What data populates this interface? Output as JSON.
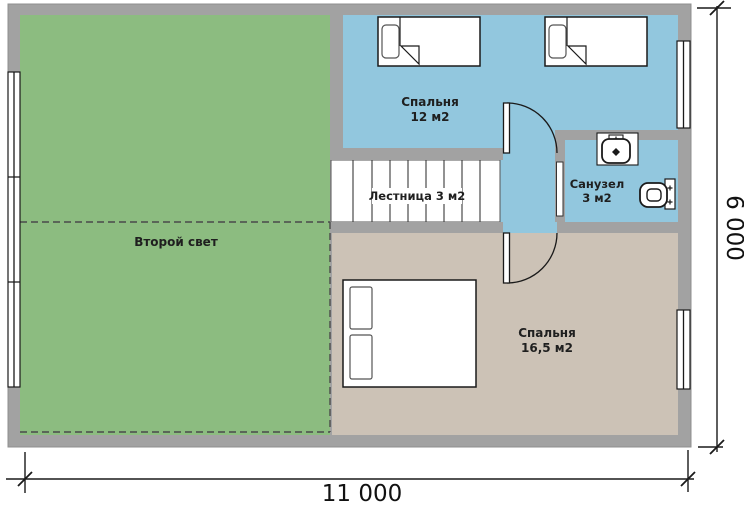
{
  "rooms": [
    {
      "id": "second-light",
      "label": "Второй свет"
    },
    {
      "id": "bedroom-12",
      "label": "Спальня",
      "area": "12 м2"
    },
    {
      "id": "staircase",
      "label": "Лестница 3 м2"
    },
    {
      "id": "bathroom",
      "label": "Санузел",
      "area": "3 м2"
    },
    {
      "id": "bedroom-16",
      "label": "Спальня",
      "area": "16,5 м2"
    }
  ],
  "dimensions": {
    "width": "11 000",
    "height": "6 000"
  },
  "colors": {
    "wall": "#a2a2a2",
    "wall_edge": "#8f8f8f",
    "second_light": "#8cbc80",
    "blue_room": "#92c7de",
    "beige_room": "#ccc2b6",
    "stair_floor": "#ffffff",
    "line": "#1a1a1a",
    "dashed_line": "#4a4a4a",
    "label_text": "#1f1f1f"
  },
  "fixtures": [
    {
      "icon": "single-bed-icon",
      "room": "Спальня 12 м2",
      "count": 2
    },
    {
      "icon": "double-bed-icon",
      "room": "Спальня 16,5 м2",
      "count": 1
    },
    {
      "icon": "sink-icon",
      "room": "Санузел 3 м2",
      "count": 1
    },
    {
      "icon": "toilet-icon",
      "room": "Санузел 3 м2",
      "count": 1
    },
    {
      "icon": "stairs-icon",
      "room": "Лестница 3 м2",
      "count": 1
    },
    {
      "icon": "window-icon",
      "room": "",
      "count": 3
    },
    {
      "icon": "door-icon",
      "room": "",
      "count": 3
    }
  ]
}
